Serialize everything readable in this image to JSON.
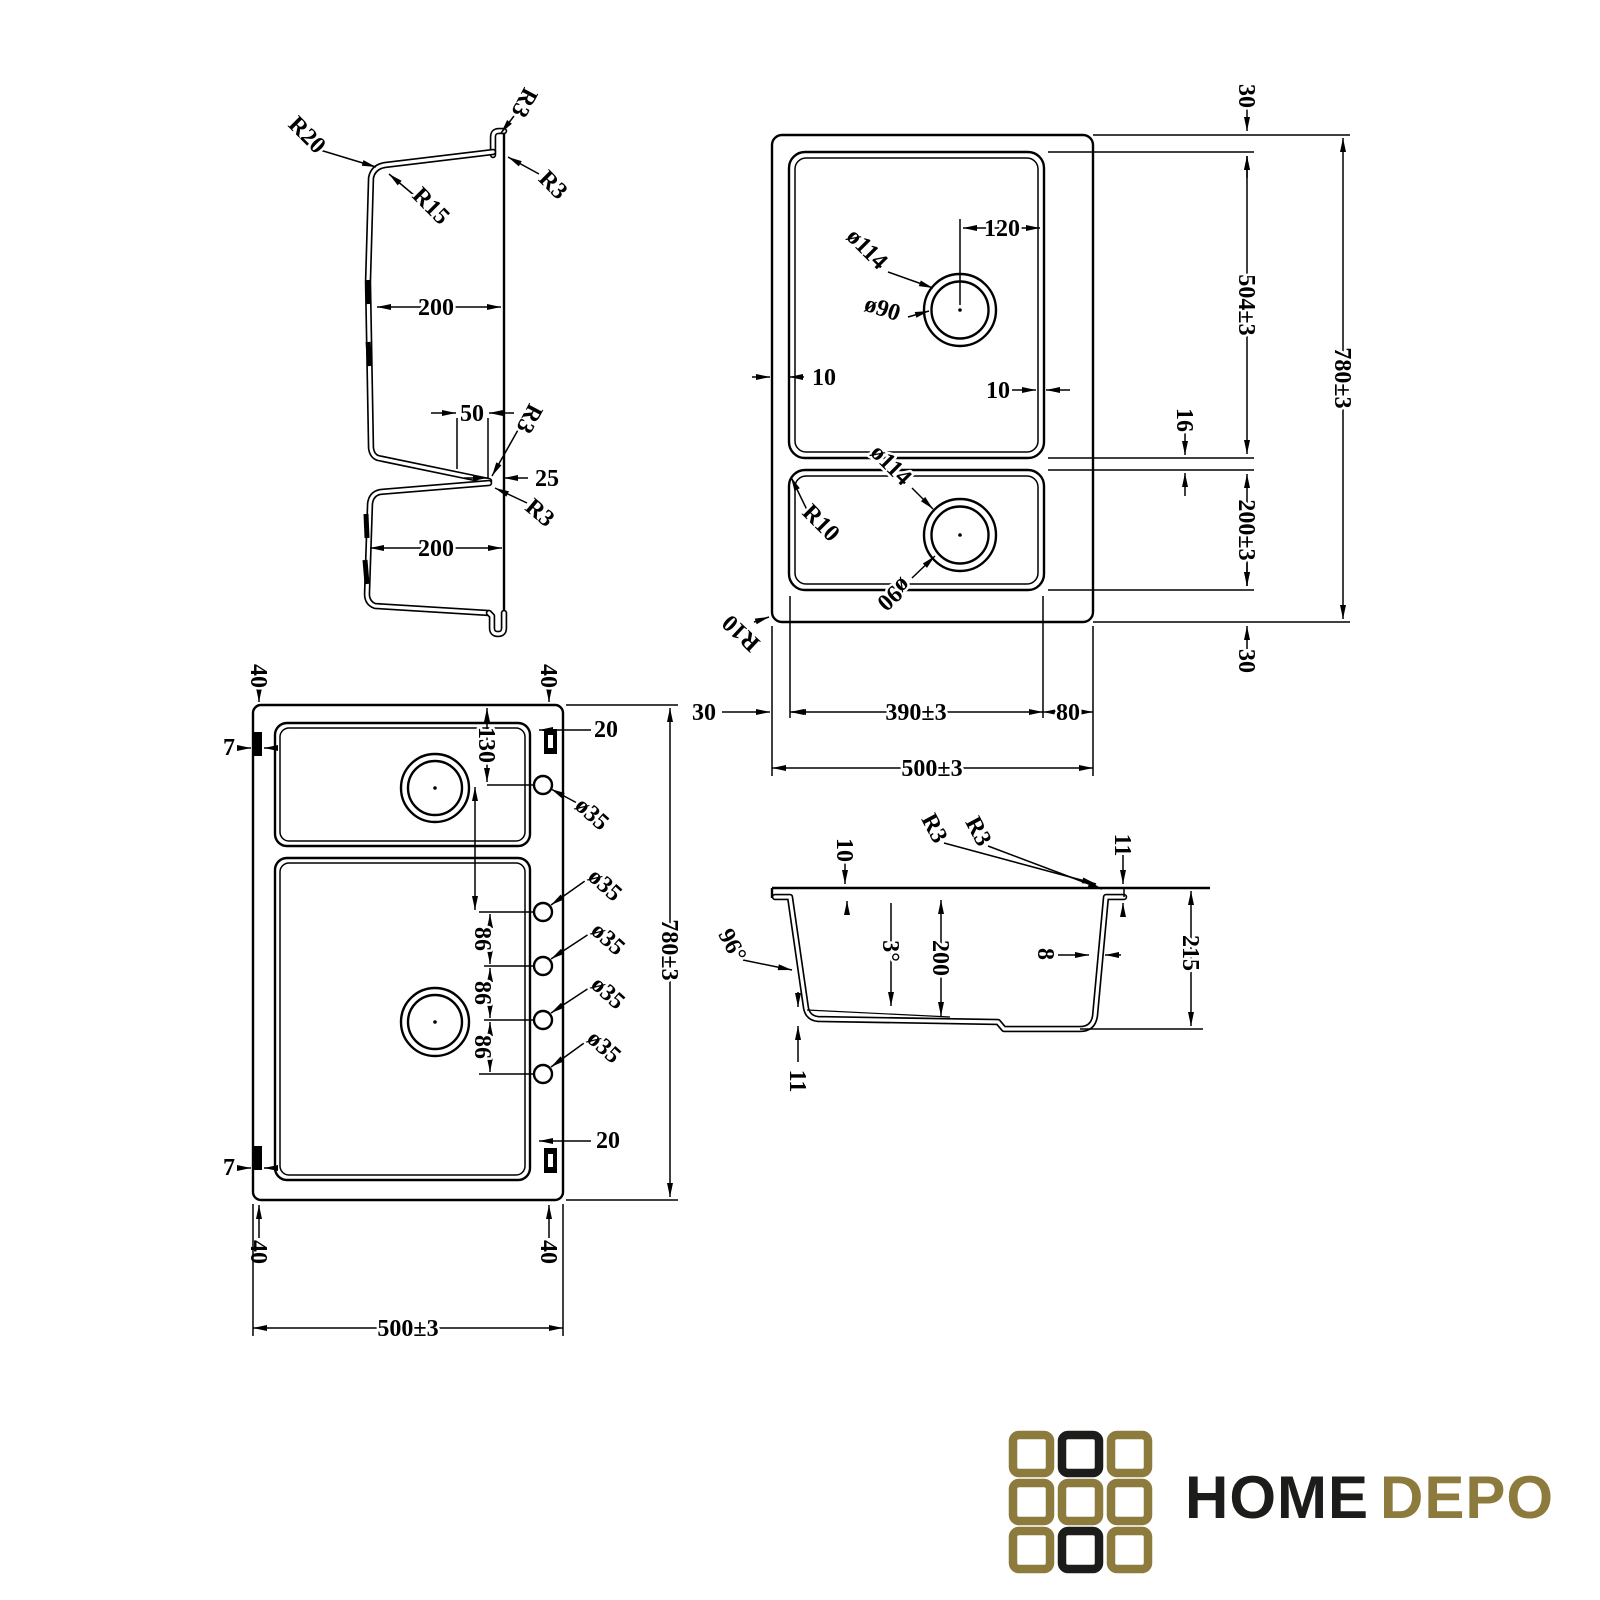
{
  "section_profile": {
    "r20": "R20",
    "r15": "R15",
    "r3_hook": "R3",
    "r3_rim": "R3",
    "top_bowl_width": "200",
    "notch_width": "50",
    "notch_offset": "25",
    "r3_notch_upper": "R3",
    "r3_notch_lower": "R3",
    "bottom_bowl_width": "200"
  },
  "plan_view": {
    "rim_top": "30",
    "drain_offset": "120",
    "drain1_outer": "ø114",
    "drain1_inner": "ø90",
    "bowl1_length": "504±3",
    "overall_length": "780±3",
    "rim_inset_left": "10",
    "rim_inset_right": "10",
    "divider_width": "16",
    "drain2_outer": "ø114",
    "drain2_inner": "ø90",
    "bowl_corner_radius": "R10",
    "bowl2_length": "200±3",
    "rim_bottom": "30",
    "outer_corner_radius": "R10",
    "rim_left": "30",
    "bowl_width": "390±3",
    "ledge_width": "80",
    "overall_width": "500±3"
  },
  "holes_view": {
    "clip_offset_top_left": "40",
    "clip_offset_top_right": "40",
    "clip_side_top": "7",
    "clip_side_top_right": "20",
    "first_hole_offset": "130",
    "hole_diameters": [
      "ø35",
      "ø35",
      "ø35",
      "ø35",
      "ø35"
    ],
    "hole_spacings": [
      "86",
      "86",
      "86"
    ],
    "overall_length": "780±3",
    "clip_side_bottom_right": "20",
    "clip_side_bottom": "7",
    "clip_offset_bottom_left": "40",
    "clip_offset_bottom_right": "40",
    "overall_width": "500±3"
  },
  "bowl_section": {
    "ledge_depth": "10",
    "corner_outer": "R3",
    "corner_inner": "R3",
    "rim_lip": "11",
    "wall_angle": "96°",
    "floor_slope": "3°",
    "bowl_depth": "200",
    "wall_thickness": "8",
    "overall_depth": "215",
    "floor_thickness": "11"
  },
  "logo": {
    "brand_home": "HOME",
    "brand_depo": "DEPO",
    "colors": {
      "gold": "#8c7b3d",
      "dark": "#1c1c1a"
    },
    "grid_pattern": [
      [
        "gold",
        "dark",
        "gold"
      ],
      [
        "gold",
        "gold",
        "gold"
      ],
      [
        "gold",
        "dark",
        "gold"
      ]
    ]
  }
}
